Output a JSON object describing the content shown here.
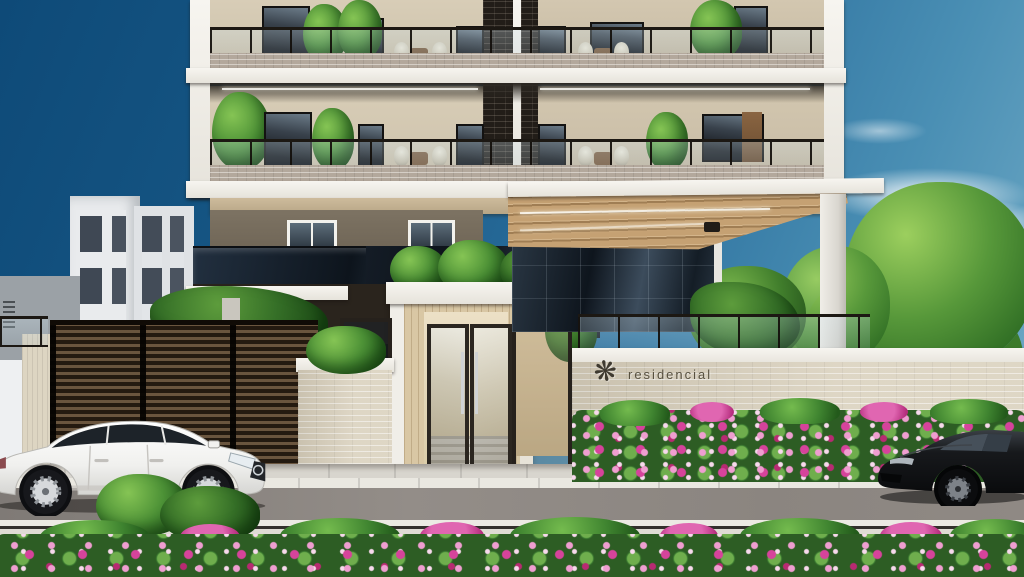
{
  "scene": {
    "type": "architectural exterior rendering",
    "description": "Street-level daytime view of a modern residential tower entrance: brick-and-beige facade with glass-railed balconies and potted plants, dark mirrored glass band, wood-slat entry canopy, double glass lobby doors, dark slatted side gates, beige perimeter wall with building sign, pink flower hedge and bed, a white sedan parked at left and a black sports car at right."
  },
  "sign": {
    "logo_glyph": "❋",
    "label": "residencial"
  },
  "palette": {
    "sky_deep": "#0e4a78",
    "sky_light": "#77afc9",
    "cloud_white": "#e8f1f5",
    "facade_beige": "#d3c8b2",
    "facade_brown": "#79705f",
    "parapet_brick": "#b3a89c",
    "pier_dark_brick": "#221d18",
    "slab_white": "#f1efe9",
    "glass_dark": "#182430",
    "canopy_wood": "#c5a173",
    "entry_wood": "#d9c7a4",
    "perimeter_wall": "#d9d0bc",
    "gate_dark": "#241a10",
    "foliage_green": "#3c7c31",
    "flower_pink": "#e066b1",
    "flower_magenta": "#c92d84",
    "road_grey": "#8b8580",
    "sidewalk_grey": "#d8d5ce",
    "car_white": "#f2f2f0",
    "car_black": "#131417"
  }
}
